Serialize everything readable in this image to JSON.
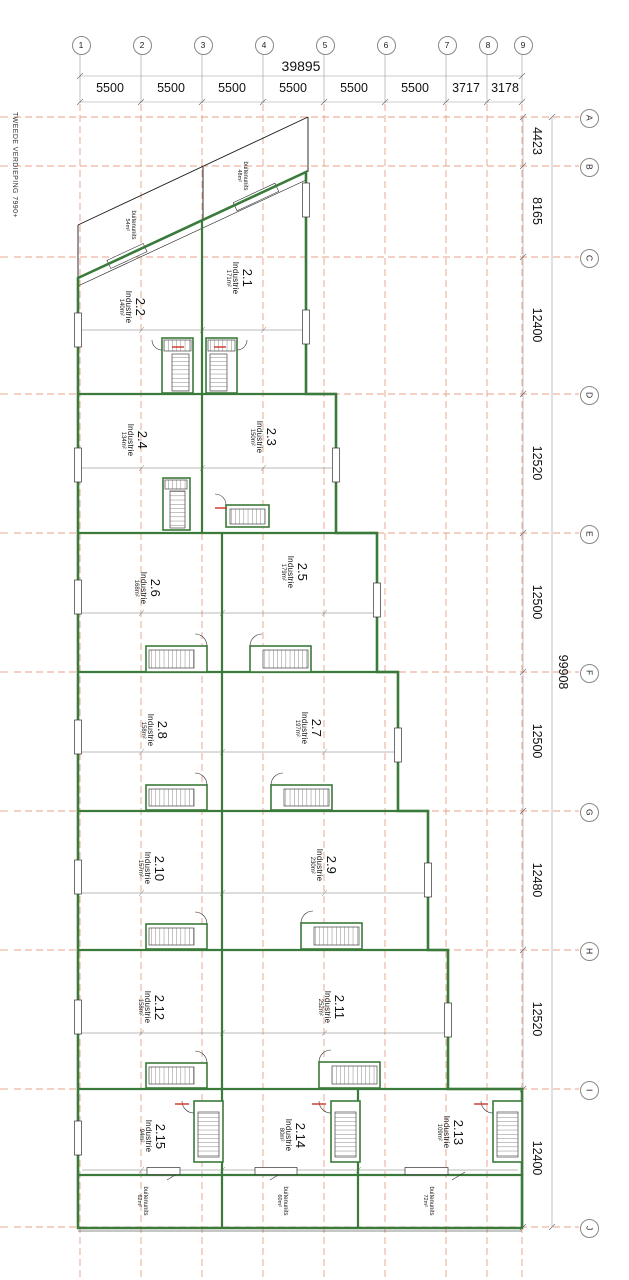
{
  "drawing": {
    "floor_label": "TWEEDE VERDIEPING 7990+"
  },
  "grid": {
    "columns": [
      "1",
      "2",
      "3",
      "4",
      "5",
      "6",
      "7",
      "8",
      "9"
    ],
    "rows": [
      "A",
      "B",
      "C",
      "D",
      "E",
      "F",
      "G",
      "H",
      "I",
      "J"
    ],
    "top_total": "39895",
    "top_segments": [
      "5500",
      "5500",
      "5500",
      "5500",
      "5500",
      "5500",
      "3717",
      "3178"
    ],
    "right_total": "99908",
    "right_segments": [
      "4423",
      "8165",
      "12400",
      "12520",
      "12500",
      "12500",
      "12480",
      "12520",
      "12400"
    ]
  },
  "rooms": [
    {
      "number": "2.1",
      "type": "Industrie",
      "area": "171m²"
    },
    {
      "number": "2.2",
      "type": "Industrie",
      "area": "140m²"
    },
    {
      "number": "2.3",
      "type": "Industrie",
      "area": "150m²"
    },
    {
      "number": "2.4",
      "type": "Industrie",
      "area": "134m²"
    },
    {
      "number": "2.5",
      "type": "Industrie",
      "area": "179m²"
    },
    {
      "number": "2.6",
      "type": "Industrie",
      "area": "168m²"
    },
    {
      "number": "2.7",
      "type": "Industrie",
      "area": "197m²"
    },
    {
      "number": "2.8",
      "type": "Industrie",
      "area": "158m²"
    },
    {
      "number": "2.9",
      "type": "Industrie",
      "area": "230m²"
    },
    {
      "number": "2.10",
      "type": "Industrie",
      "area": "157m²"
    },
    {
      "number": "2.11",
      "type": "Industrie",
      "area": "252m²"
    },
    {
      "number": "2.12",
      "type": "Industrie",
      "area": "158m²"
    },
    {
      "number": "2.13",
      "type": "Industrie",
      "area": "109m²"
    },
    {
      "number": "2.14",
      "type": "Industrie",
      "area": "80m²"
    },
    {
      "number": "2.15",
      "type": "Industrie",
      "area": "94m²"
    }
  ],
  "outdoor_units": [
    {
      "label": "buitenunits",
      "area": "54m²"
    },
    {
      "label": "buitenunits",
      "area": "48m²"
    },
    {
      "label": "buitenunits",
      "area": "62m²"
    },
    {
      "label": "buitenunits",
      "area": "60m²"
    },
    {
      "label": "buitenunits",
      "area": "72m²"
    }
  ],
  "colors": {
    "wall_green": "#3a7a3a",
    "grid_salmon": "#e8a288",
    "line_black": "#1a1a1a",
    "dim_gray": "#888888",
    "accent_red": "#cc3322"
  }
}
